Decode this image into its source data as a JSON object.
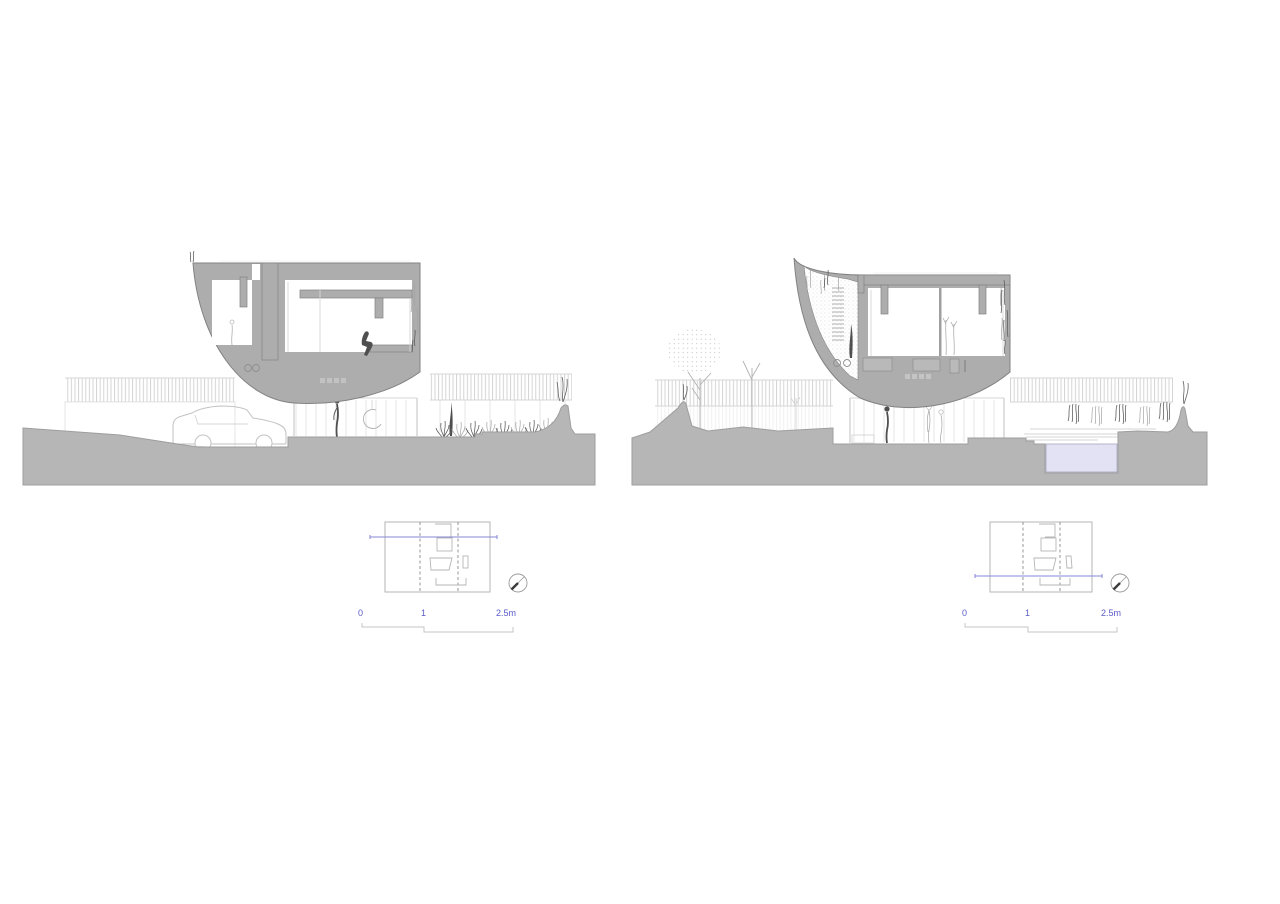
{
  "document": {
    "background": "#ffffff"
  },
  "colors": {
    "background": "#ffffff",
    "ground": "#b6b6b6",
    "ground_edge": "#9e9e9e",
    "poche": "#adadad",
    "poche_outline": "#828282",
    "line_light": "#d6d6d6",
    "line_mid": "#b2b2b2",
    "line_dark": "#6f6f6f",
    "figure_dark": "#4f4f4f",
    "plant_dark": "#606060",
    "plant_light": "#a3a3a3",
    "plan_line": "#b5b5b5",
    "dash": "#8c8c8c",
    "accent_blue": "#5a5acb",
    "section_line": "#8585d6",
    "scalebar": "#c6c6c6",
    "pool_fill": "#e2e2f4",
    "pool_edge": "#a6a6bd"
  },
  "views": {
    "left": {
      "scale_bar": {
        "tick_zero": "0",
        "tick_one": "1",
        "tick_max": "2.5m"
      }
    },
    "right": {
      "scale_bar": {
        "tick_zero": "0",
        "tick_one": "1",
        "tick_max": "2.5m"
      }
    }
  }
}
